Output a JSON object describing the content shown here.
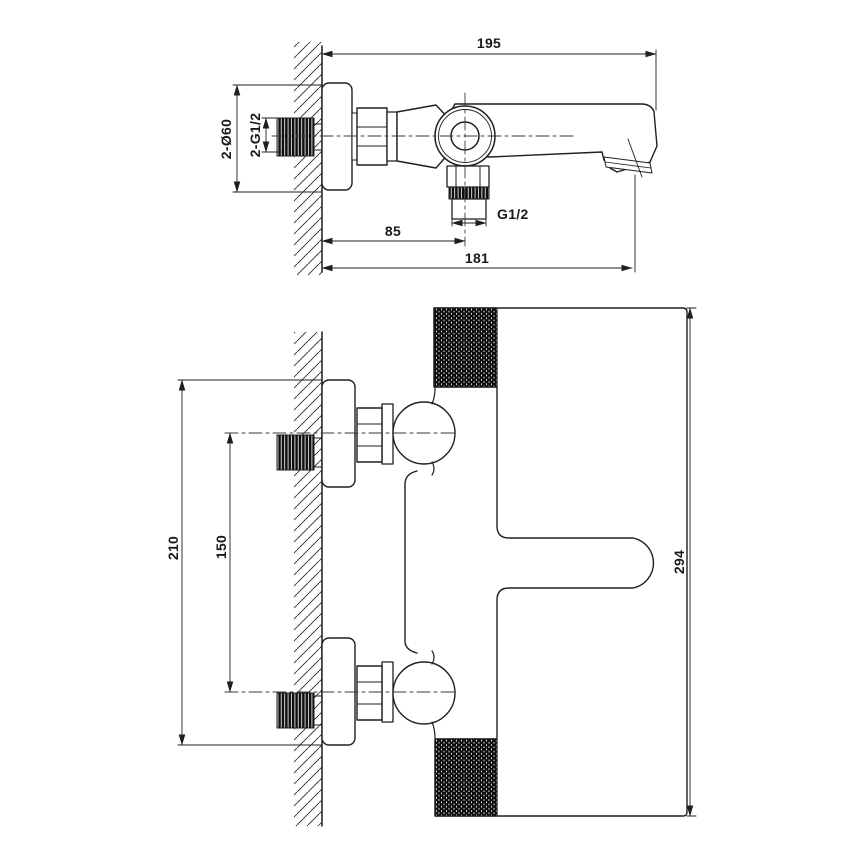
{
  "dimensions": {
    "side_view": {
      "total_depth": "195",
      "spout_outlet_offset": "85",
      "spout_reach": "181",
      "shower_outlet_thread": "G1/2",
      "wall_flange": "2-Ø60",
      "wall_connection_thread": "2-G1/2"
    },
    "front_view": {
      "flange_outer_span": "210",
      "connection_centres": "150",
      "body_height": "294"
    }
  },
  "colors": {
    "line": "#1f1f1f",
    "background": "#ffffff"
  }
}
